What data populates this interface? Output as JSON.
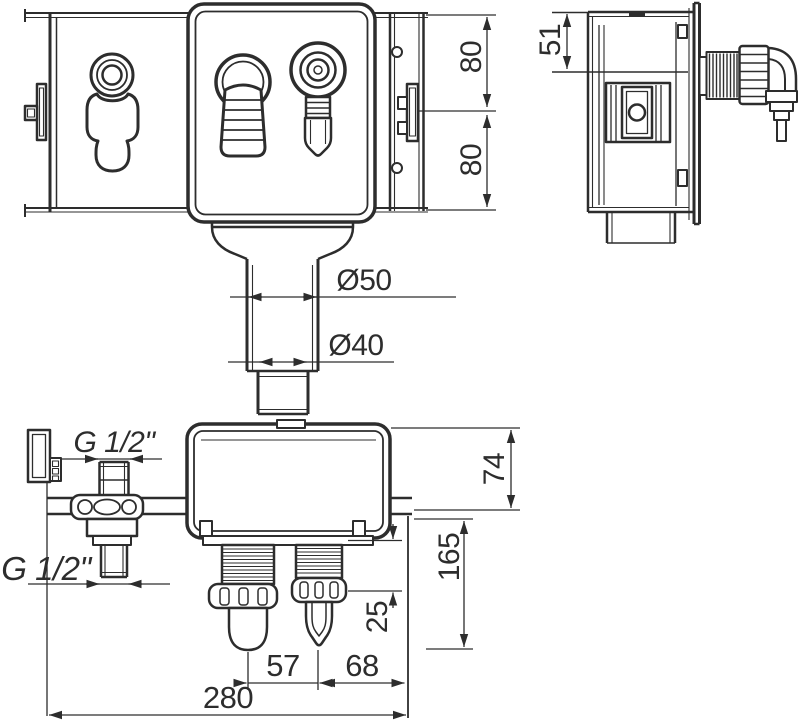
{
  "drawing": {
    "type": "technical-drawing",
    "background": "#ffffff",
    "line_color": "#2d2d2d",
    "labels": {
      "dia50": "Ø50",
      "dia40": "Ø40",
      "g_half_upper": "G 1/2\"",
      "g_half_lower": "G 1/2\"",
      "h80_top": "80",
      "h80_bottom": "80",
      "off51": "51",
      "h74": "74",
      "d165": "165",
      "h25": "25",
      "w57": "57",
      "w68": "68",
      "w280": "280"
    }
  }
}
